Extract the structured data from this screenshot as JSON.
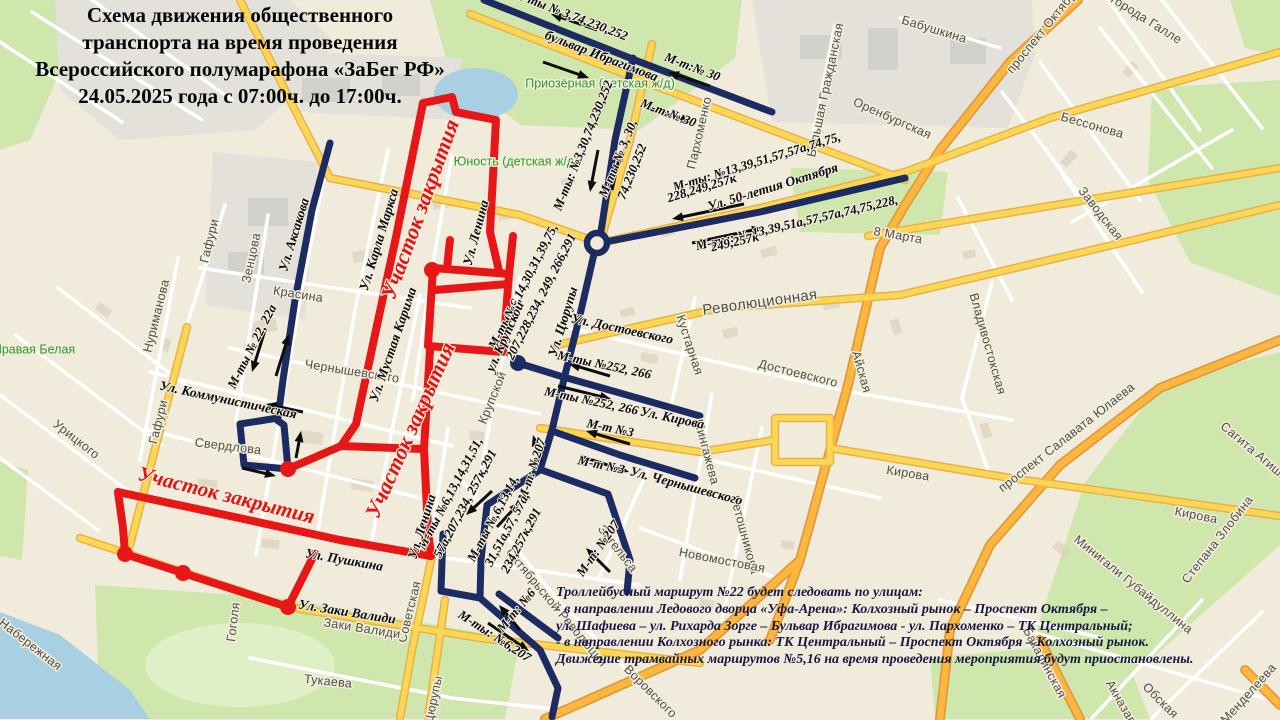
{
  "title": {
    "lines": [
      "Схема движения общественного",
      "транспорта на время проведения",
      "Всероссийского полумарафона «ЗаБег РФ»",
      "24.05.2025 года с 07:00ч. до 17:00ч."
    ]
  },
  "note": {
    "lines": [
      "Троллейбусный маршрут №22 будет следовать по улицам:",
      "- в направлении Ледового дворца «Уфа-Арена»: Колхозный рынок – Проспект Октября –",
      "ул. Шафиева – ул. Рихарда Зорге – Бульвар Ибрагимова - ул. Пархоменко – ТК Центральный;",
      "- в направлении Колхозного рынка: ТК Центральный – Проспект Октября – Колхозный рынок.",
      "Движение трамвайных маршрутов №5,16 на время проведения мероприятия будут приостановлены."
    ]
  },
  "palette": {
    "bg": "#f0ebdb",
    "park": "#cfe7ad",
    "park_light": "#dff0c6",
    "water": "#a9cfe3",
    "gray_zone": "#e3e1da",
    "building": "#d9cfba",
    "building_gray": "#d2d1cc",
    "minor_street": "#ffffff",
    "road_yellow": "#fdd653",
    "road_yellow_casing": "#e4b34d",
    "road_orange": "#feb63f",
    "road_orange_casing": "#de9b3c",
    "route_closed": "#e81717",
    "route_detour": "#1d2b63",
    "arrow": "#0d0d0d",
    "street_text": "#4f4f47",
    "landmark_text": "#2f9a2b",
    "closure_text": "#e51212",
    "label_text": "#0a0a10"
  },
  "map": {
    "route_labels": [
      {
        "text": "М-ты  № 3,74,230,252",
        "x": 570,
        "y": 16,
        "r": 21
      },
      {
        "text": "М-т:№ 30",
        "x": 692,
        "y": 68,
        "r": 21
      },
      {
        "text": "М-т:№ 30",
        "x": 668,
        "y": 114,
        "r": 21
      },
      {
        "text": "М-ты: №3,30,74,230,252",
        "x": 584,
        "y": 146,
        "r": -68
      },
      {
        "text": "М-ты № 3, 30,",
        "x": 619,
        "y": 159,
        "r": -68
      },
      {
        "text": "74,230,252",
        "x": 633,
        "y": 172,
        "r": -68
      },
      {
        "text": "М-ты: №13,39,51,57,57а,74,75,",
        "x": 757,
        "y": 163,
        "r": -17
      },
      {
        "text": "228,249,257к",
        "x": 702,
        "y": 189,
        "r": -17
      },
      {
        "text": "М-ты: № 13,39,51а,57,57а,74,75,228,",
        "x": 797,
        "y": 224,
        "r": -13
      },
      {
        "text": "249,257к",
        "x": 735,
        "y": 243,
        "r": -13
      },
      {
        "text": "М-ты №252, 266",
        "x": 604,
        "y": 366,
        "r": 12
      },
      {
        "text": "М-ты №252, 266",
        "x": 591,
        "y": 402,
        "r": 12
      },
      {
        "text": "М-т №3",
        "x": 610,
        "y": 429,
        "r": 12
      },
      {
        "text": "М-т №3",
        "x": 601,
        "y": 466,
        "r": 12
      },
      {
        "text": "М-т: №207",
        "x": 533,
        "y": 470,
        "r": -72
      },
      {
        "text": "М-т: №207",
        "x": 599,
        "y": 549,
        "r": -55
      },
      {
        "text": "М-ты№6,14,30,31,39,75,",
        "x": 524,
        "y": 287,
        "r": -63
      },
      {
        "text": "207,228,234, 249, 266,291",
        "x": 542,
        "y": 297,
        "r": -63
      },
      {
        "text": "М-ты № 22, 22а",
        "x": 253,
        "y": 347,
        "r": -63
      },
      {
        "text": "М-ты №6,13,14,31,51,",
        "x": 451,
        "y": 494,
        "r": -62
      },
      {
        "text": "57а,207,234, 257к,291",
        "x": 466,
        "y": 504,
        "r": -62
      },
      {
        "text": "М-ты №,6,13,14,",
        "x": 494,
        "y": 519,
        "r": -62
      },
      {
        "text": "31,51а,57, 57а,",
        "x": 508,
        "y": 530,
        "r": -62
      },
      {
        "text": "234,257к,291",
        "x": 522,
        "y": 541,
        "r": -62
      },
      {
        "text": "М-т: №6",
        "x": 517,
        "y": 611,
        "r": -50
      },
      {
        "text": "М-ты: №6,207",
        "x": 494,
        "y": 637,
        "r": 33
      }
    ],
    "creator_street_labels": [
      {
        "text": "бульвар Ибрагимова",
        "x": 601,
        "y": 57,
        "r": 21
      },
      {
        "text": "Ул. 50-летия Октября",
        "x": 773,
        "y": 188,
        "r": -17
      },
      {
        "text": "Ул. Достоевского",
        "x": 622,
        "y": 330,
        "r": 12
      },
      {
        "text": "Ул. Кирова",
        "x": 672,
        "y": 419,
        "r": 12
      },
      {
        "text": "Ул. Чернышевского",
        "x": 686,
        "y": 487,
        "r": 15
      },
      {
        "text": "Ул. Коммунистическая",
        "x": 228,
        "y": 401,
        "r": 12
      },
      {
        "text": "Ул. Пушкина",
        "x": 344,
        "y": 561,
        "r": 10
      },
      {
        "text": "Ул. Заки Валиди",
        "x": 347,
        "y": 613,
        "r": 9
      },
      {
        "text": "Ул. Аксакова",
        "x": 295,
        "y": 235,
        "r": -73
      },
      {
        "text": "Ул. Карла Маркса",
        "x": 380,
        "y": 240,
        "r": -73
      },
      {
        "text": "Ул. Ленина",
        "x": 477,
        "y": 233,
        "r": -75
      },
      {
        "text": "Ул. Ленина",
        "x": 423,
        "y": 527,
        "r": -73
      },
      {
        "text": "Ул. Мустая Карима",
        "x": 394,
        "y": 345,
        "r": -71
      },
      {
        "text": "ул. Крупской",
        "x": 506,
        "y": 337,
        "r": -66
      },
      {
        "text": "Ул. Цюрупы",
        "x": 564,
        "y": 322,
        "r": -73
      }
    ],
    "closure_labels": [
      {
        "text": "Участок закрытия",
        "x": 422,
        "y": 210,
        "r": -70,
        "fs": 22
      },
      {
        "text": "Участок закрытия",
        "x": 412,
        "y": 431,
        "r": -66,
        "fs": 22
      },
      {
        "text": "Участок закрытия",
        "x": 226,
        "y": 497,
        "r": 14,
        "fs": 21
      }
    ],
    "street_labels": [
      {
        "text": "Красина",
        "x": 298,
        "y": 295,
        "r": 9
      },
      {
        "text": "Чернышевского",
        "x": 352,
        "y": 372,
        "r": 9
      },
      {
        "text": "Свердлова",
        "x": 228,
        "y": 447,
        "r": 7
      },
      {
        "text": "Гоголя",
        "x": 234,
        "y": 622,
        "r": -83
      },
      {
        "text": "Советская",
        "x": 410,
        "y": 612,
        "r": -76
      },
      {
        "text": "Заки Валиди",
        "x": 362,
        "y": 629,
        "r": 9
      },
      {
        "text": "Тукаева",
        "x": 328,
        "y": 682,
        "r": 6
      },
      {
        "text": "Набережная",
        "x": 30,
        "y": 645,
        "r": 38
      },
      {
        "text": "Зенцова",
        "x": 252,
        "y": 258,
        "r": -78
      },
      {
        "text": "Нуриманова",
        "x": 157,
        "y": 316,
        "r": -76
      },
      {
        "text": "Гафури",
        "x": 210,
        "y": 241,
        "r": -76
      },
      {
        "text": "Гафури",
        "x": 159,
        "y": 422,
        "r": -76
      },
      {
        "text": "Урицкого",
        "x": 76,
        "y": 440,
        "r": 38
      },
      {
        "text": "Крупской",
        "x": 493,
        "y": 398,
        "r": -68
      },
      {
        "text": "Мингажева",
        "x": 706,
        "y": 452,
        "r": 75
      },
      {
        "text": "Ветошникова",
        "x": 744,
        "y": 535,
        "r": 75
      },
      {
        "text": "Кустарная",
        "x": 689,
        "y": 345,
        "r": 72
      },
      {
        "text": "Достоевского",
        "x": 798,
        "y": 374,
        "r": 14
      },
      {
        "text": "Революционная",
        "x": 760,
        "y": 303,
        "r": -8,
        "big": true
      },
      {
        "text": "Энгельса",
        "x": 617,
        "y": 549,
        "r": 52
      },
      {
        "text": "Новомостовая",
        "x": 722,
        "y": 561,
        "r": 11
      },
      {
        "text": "Октябрьской Революции",
        "x": 556,
        "y": 608,
        "r": 50
      },
      {
        "text": "Воровского",
        "x": 650,
        "y": 692,
        "r": 45
      },
      {
        "text": "Цюрупы",
        "x": 434,
        "y": 700,
        "r": -78
      },
      {
        "text": "Кирова",
        "x": 908,
        "y": 474,
        "r": 9
      },
      {
        "text": "Кирова",
        "x": 1196,
        "y": 516,
        "r": 11
      },
      {
        "text": "Пархоменко",
        "x": 700,
        "y": 133,
        "r": -77
      },
      {
        "text": "Оренбургская",
        "x": 892,
        "y": 119,
        "r": 24
      },
      {
        "text": "Бабушкина",
        "x": 934,
        "y": 30,
        "r": 17
      },
      {
        "text": "Большая Гражданская",
        "x": 826,
        "y": 90,
        "r": -78
      },
      {
        "text": "города Галле",
        "x": 1146,
        "y": 20,
        "r": 32
      },
      {
        "text": "проспект Октября",
        "x": 1044,
        "y": 30,
        "r": -51
      },
      {
        "text": "Бессонова",
        "x": 1092,
        "y": 126,
        "r": 16
      },
      {
        "text": "Заводская",
        "x": 1100,
        "y": 214,
        "r": 52
      },
      {
        "text": "8 Марта",
        "x": 898,
        "y": 236,
        "r": 10
      },
      {
        "text": "Айская",
        "x": 861,
        "y": 372,
        "r": 74
      },
      {
        "text": "Владивостокская",
        "x": 987,
        "y": 344,
        "r": 74
      },
      {
        "text": "проспект Салавата Юлаева",
        "x": 1067,
        "y": 438,
        "r": -38
      },
      {
        "text": "Сагита Агиша",
        "x": 1254,
        "y": 452,
        "r": 40
      },
      {
        "text": "Минигали Губайдуллина",
        "x": 1133,
        "y": 585,
        "r": 39
      },
      {
        "text": "Степана Злобина",
        "x": 1218,
        "y": 540,
        "r": -52
      },
      {
        "text": "Обская",
        "x": 1160,
        "y": 701,
        "r": 45
      },
      {
        "text": "Менделеева",
        "x": 1249,
        "y": 694,
        "r": -48
      },
      {
        "text": "Акназарова",
        "x": 1126,
        "y": 712,
        "r": 60
      },
      {
        "text": "Бакалинская",
        "x": 1044,
        "y": 663,
        "r": 62
      }
    ],
    "landmark_labels": [
      {
        "text": "Приозёрная (детская ж/д)",
        "x": 600,
        "y": 84,
        "r": 0
      },
      {
        "text": "Юность (детская ж/д)",
        "x": 516,
        "y": 162,
        "r": 0
      },
      {
        "text": "Правая Белая",
        "x": 34,
        "y": 350,
        "r": 0
      }
    ],
    "arrows": [
      [
        597,
        30,
        551,
        14
      ],
      [
        543,
        62,
        589,
        78
      ],
      [
        710,
        86,
        668,
        72
      ],
      [
        647,
        108,
        692,
        122
      ],
      [
        598,
        150,
        590,
        192
      ],
      [
        612,
        190,
        621,
        150
      ],
      [
        744,
        204,
        672,
        219
      ],
      [
        692,
        243,
        763,
        228
      ],
      [
        265,
        330,
        252,
        372
      ],
      [
        276,
        376,
        289,
        334
      ],
      [
        303,
        412,
        266,
        404
      ],
      [
        296,
        458,
        301,
        431
      ],
      [
        242,
        468,
        276,
        476
      ],
      [
        610,
        376,
        569,
        364
      ],
      [
        558,
        386,
        611,
        399
      ],
      [
        630,
        444,
        586,
        431
      ],
      [
        580,
        456,
        629,
        472
      ],
      [
        541,
        462,
        533,
        435
      ],
      [
        610,
        572,
        586,
        548
      ],
      [
        492,
        491,
        466,
        515
      ],
      [
        497,
        527,
        520,
        502
      ],
      [
        520,
        630,
        499,
        605
      ],
      [
        488,
        623,
        529,
        651
      ]
    ],
    "stop_dots": {
      "closed": [
        [
          125,
          554
        ],
        [
          183,
          573
        ],
        [
          288,
          607
        ],
        [
          288,
          469
        ],
        [
          432,
          270
        ]
      ],
      "detour": [
        [
          518,
          363
        ]
      ]
    },
    "roundabout": [
      597,
      243
    ]
  }
}
